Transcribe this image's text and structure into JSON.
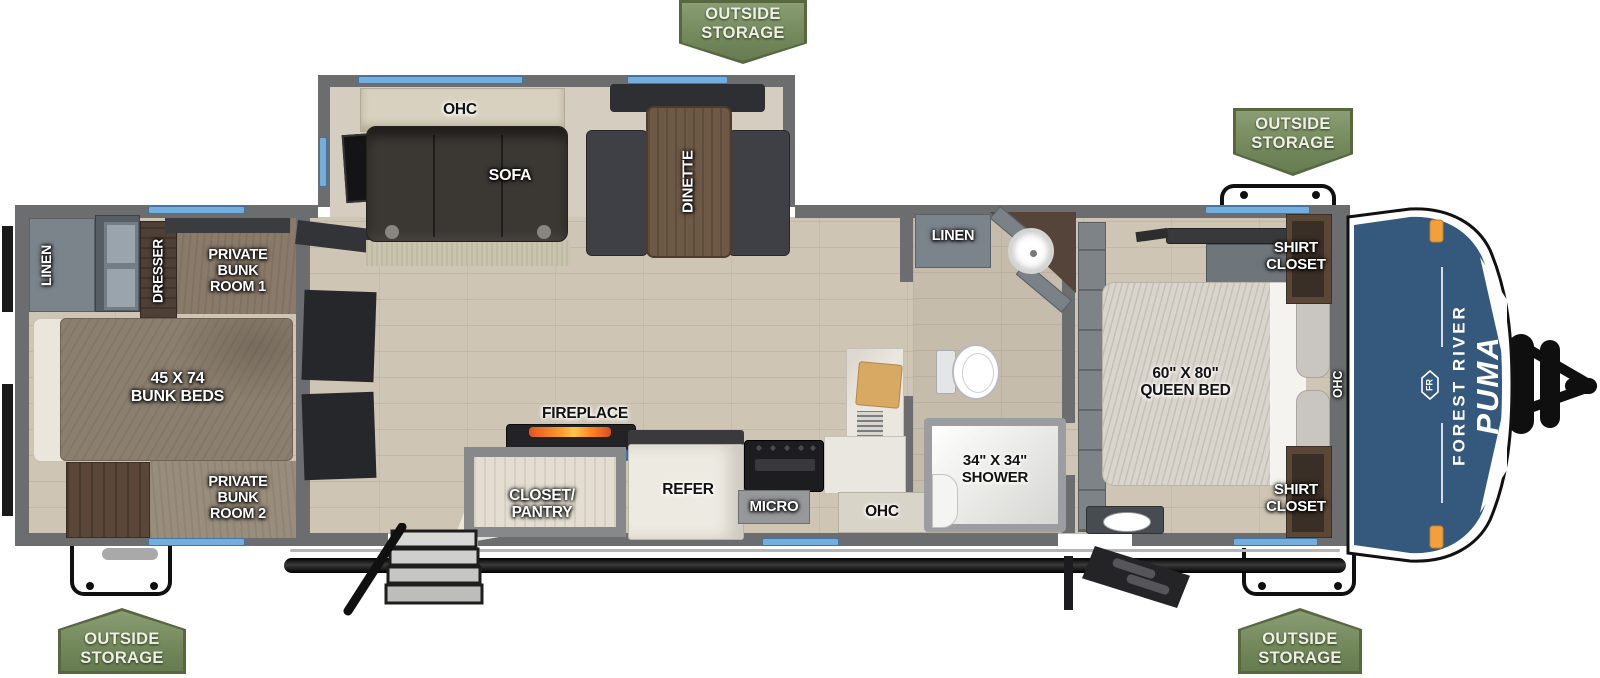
{
  "branding": {
    "manufacturer": "FOREST RIVER",
    "model": "PUMA",
    "logo_monogram": "FR"
  },
  "badges": {
    "outside_storage": "OUTSIDE\nSTORAGE"
  },
  "rear_bunk_area": {
    "linen": "LINEN",
    "dresser": "DRESSER",
    "bunk_room_1": "PRIVATE\nBUNK\nROOM 1",
    "bunk_beds": "45 X 74\nBUNK BEDS",
    "bunk_room_2": "PRIVATE\nBUNK\nROOM 2"
  },
  "living_area": {
    "ohc": "OHC",
    "sofa": "SOFA",
    "dinette": "DINETTE",
    "fireplace": "FIREPLACE"
  },
  "kitchen": {
    "closet_pantry": "CLOSET/\nPANTRY",
    "refer": "REFER",
    "micro": "MICRO",
    "ohc": "OHC"
  },
  "bathroom": {
    "linen": "LINEN",
    "shower": "34\" X 34\"\nSHOWER"
  },
  "bedroom": {
    "queen_bed": "60\" X 80\"\nQUEEN BED",
    "shirt_closet": "SHIRT\nCLOSET",
    "ohc": "OHC"
  },
  "colors": {
    "badge_green": "#74895c",
    "window_blue": "#74aede",
    "front_cap_blue": "#35597c",
    "wall_gray": "#6c6d6f",
    "marker_light_orange": "#f2a03c",
    "fireplace_accent_blue": "#3e6fa5"
  }
}
